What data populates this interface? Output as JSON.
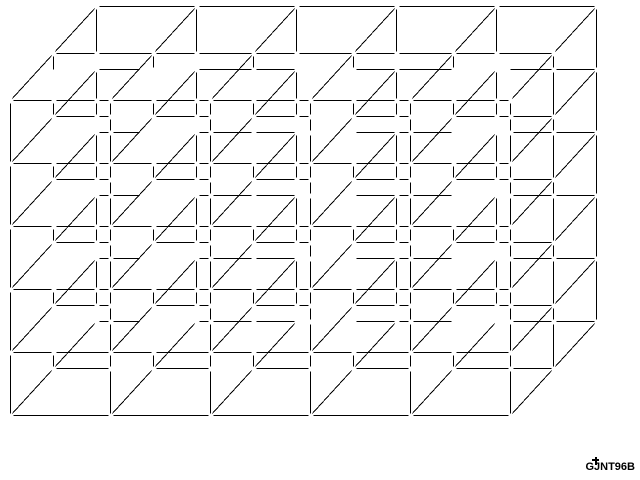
{
  "canvas": {
    "width": 640,
    "height": 480,
    "background": "#ffffff",
    "stroke_color": "#000000",
    "stroke_width": 1,
    "node_gap_px": 5
  },
  "lattice": {
    "projection": "oblique",
    "cols": 5,
    "rows": 5,
    "depth_cells": 2,
    "front_origin_x": 10,
    "front_origin_y": 100,
    "col_step_px": 100,
    "row_step_px": 63,
    "depth_step_dx_px": 43,
    "depth_step_dy_px": -47,
    "hidden_vertical_visible_px": 16,
    "front_layer_solid": true,
    "diagonals_from_every_front_node": true
  },
  "watermark": {
    "text": "GJNT96B",
    "color": "#000000",
    "has_figure_mark": true
  }
}
